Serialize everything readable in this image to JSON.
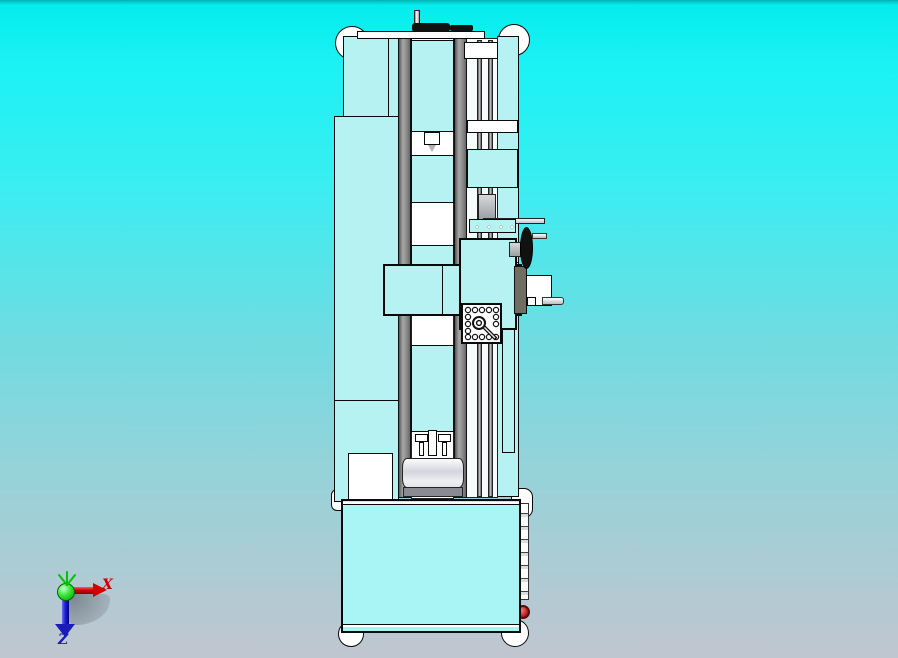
{
  "viewport": {
    "bg_top_color": "#00b4b4",
    "bg_cyan_color": "#19f2f4",
    "bg_bottom_color": "#c0c6d0",
    "model_fill_color": "#b6f2f1",
    "model_outline_color": "#0a0a0a"
  },
  "machine": {
    "rail_color": "#8a8a8a",
    "handwheel_color": "#111111",
    "side_plate_color": "#6e6e62",
    "knob_color": "#c03030"
  },
  "axis_triad": {
    "x_label": "X",
    "z_label": "Z",
    "x_color": "#cc0000",
    "y_color": "#00c400",
    "z_color": "#1a1ab8"
  }
}
